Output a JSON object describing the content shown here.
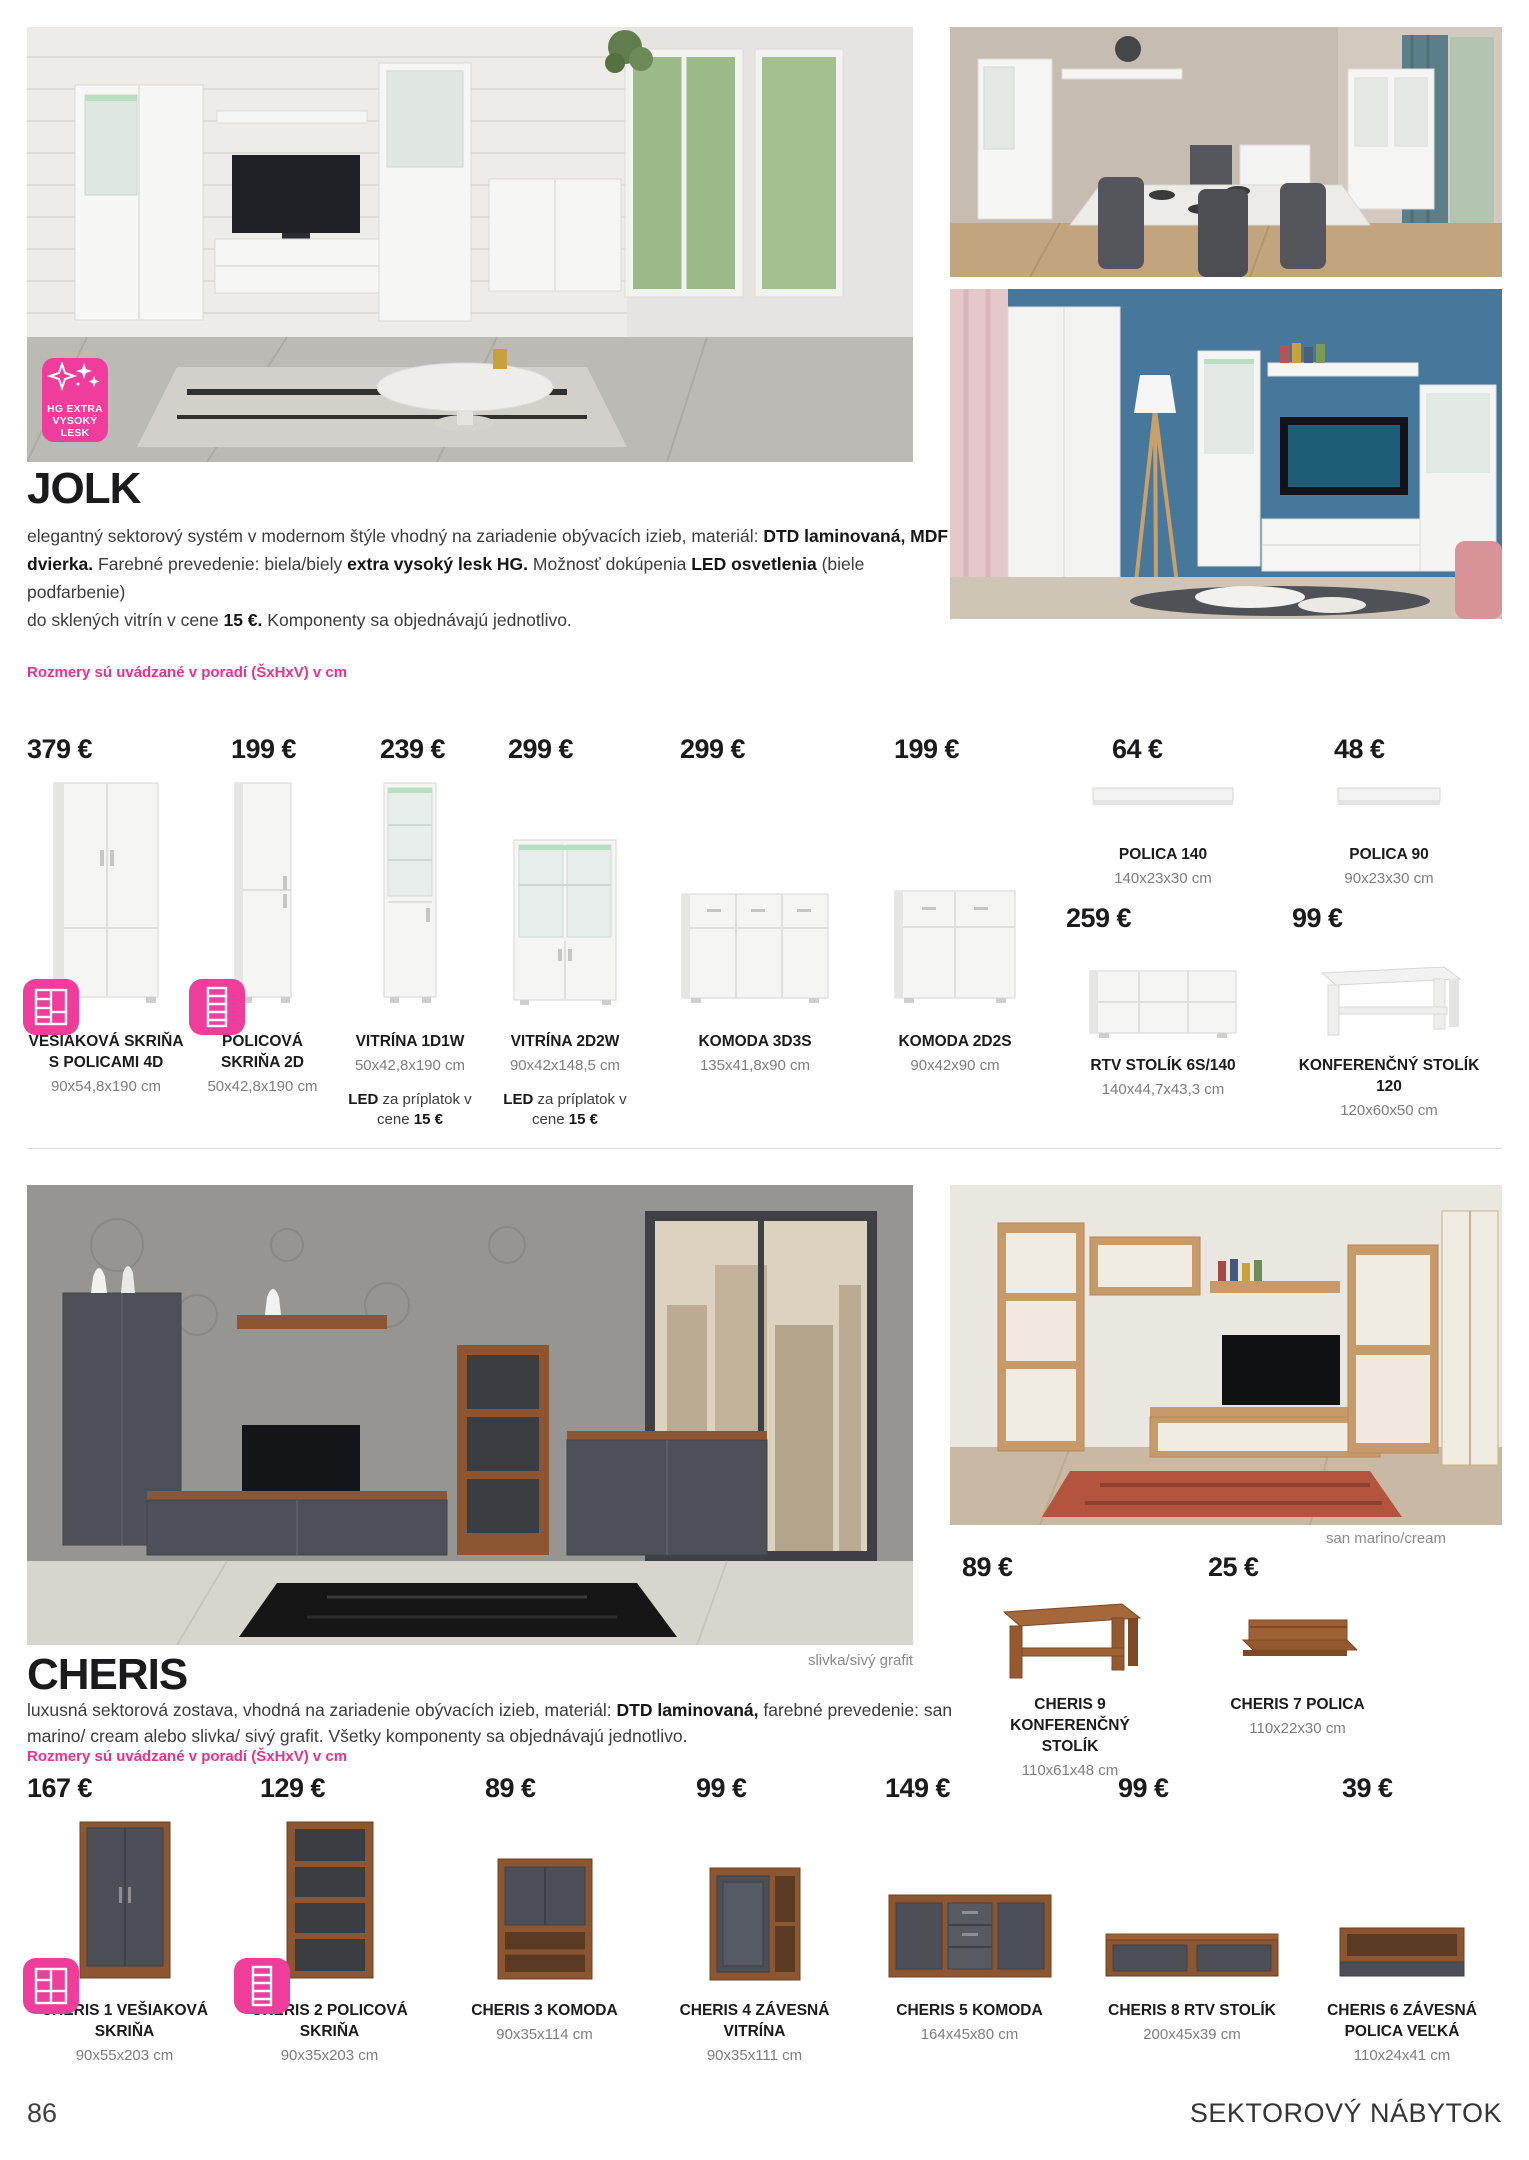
{
  "colors": {
    "accent_pink": "#e73390",
    "badge_pink": "#ee3d9b",
    "text_dark": "#1d1d1f",
    "dims_grey": "#7e7e7e"
  },
  "hg_badge": {
    "line1": "HG EXTRA",
    "line2": "VYSOKÝ",
    "line3": "LESK"
  },
  "jolk": {
    "title": "JOLK",
    "description_segments": [
      {
        "t": "elegantný sektorový systém v modernom štýle vhodný na zariadenie obývacích izieb, materiál: "
      },
      {
        "t": "DTD laminovaná, MDF",
        "b": true
      },
      {
        "br": true
      },
      {
        "t": "dvierka.",
        "b": true
      },
      {
        "t": " Farebné prevedenie: biela/biely "
      },
      {
        "t": "extra vysoký lesk HG.",
        "b": true
      },
      {
        "t": " Možnosť dokúpenia "
      },
      {
        "t": "LED osvetlenia",
        "b": true
      },
      {
        "t": " (biele podfarbenie)"
      },
      {
        "br": true
      },
      {
        "t": "do sklených vitrín v cene "
      },
      {
        "t": "15 €.",
        "b": true,
        "pink": true
      },
      {
        "t": " Komponenty sa objednávajú jednotlivo."
      }
    ],
    "size_note": "Rozmery sú uvádzané v poradí (ŠxHxV) v cm",
    "led_note": {
      "label": "LED",
      "text": "za príplatok v cene",
      "price": "15 €"
    },
    "products": [
      {
        "price": "379 €",
        "name": "VEŠIAKOVÁ SKRIŇA S POLICAMI 4D",
        "dims": "90x54,8x190 cm"
      },
      {
        "price": "199 €",
        "name": "POLICOVÁ SKRIŇA 2D",
        "dims": "50x42,8x190 cm"
      },
      {
        "price": "239 €",
        "name": "VITRÍNA 1D1W",
        "dims": "50x42,8x190 cm"
      },
      {
        "price": "299 €",
        "name": "VITRÍNA 2D2W",
        "dims": "90x42x148,5 cm"
      },
      {
        "price": "299 €",
        "name": "KOMODA 3D3S",
        "dims": "135x41,8x90 cm"
      },
      {
        "price": "199 €",
        "name": "KOMODA 2D2S",
        "dims": "90x42x90 cm"
      },
      {
        "price": "64 €",
        "name": "POLICA 140",
        "dims": "140x23x30 cm"
      },
      {
        "price": "48 €",
        "name": "POLICA 90",
        "dims": "90x23x30 cm"
      },
      {
        "price": "259 €",
        "name": "RTV STOLÍK 6S/140",
        "dims": "140x44,7x43,3 cm"
      },
      {
        "price": "99 €",
        "name": "KONFERENČNÝ STOLÍK 120",
        "dims": "120x60x50 cm"
      }
    ]
  },
  "cheris": {
    "title": "CHERIS",
    "description_segments": [
      {
        "t": "luxusná sektorová zostava, vhodná na zariadenie obývacích izieb, materiál: "
      },
      {
        "t": "DTD laminovaná,",
        "b": true
      },
      {
        "t": " farebné prevedenie: san"
      },
      {
        "br": true
      },
      {
        "t": "marino/ cream alebo slivka/ sivý grafit. Všetky komponenty sa objednávajú jednotlivo."
      }
    ],
    "size_note": "Rozmery sú uvádzané v poradí (ŠxHxV) v cm",
    "caption_left": "slivka/sivý grafit",
    "caption_right": "san marino/cream",
    "mid_products": [
      {
        "price": "89 €",
        "name": "CHERIS 9 KONFERENČNÝ STOLÍK",
        "dims": "110x61x48 cm"
      },
      {
        "price": "25 €",
        "name": "CHERIS 7 POLICA",
        "dims": "110x22x30 cm"
      }
    ],
    "products": [
      {
        "price": "167 €",
        "name": "CHERIS 1 VEŠIAKOVÁ SKRIŇA",
        "dims": "90x55x203 cm"
      },
      {
        "price": "129 €",
        "name": "CHERIS 2 POLICOVÁ SKRIŇA",
        "dims": "90x35x203 cm"
      },
      {
        "price": "89 €",
        "name": "CHERIS 3 KOMODA",
        "dims": "90x35x114 cm"
      },
      {
        "price": "99 €",
        "name": "CHERIS 4 ZÁVESNÁ VITRÍNA",
        "dims": "90x35x111 cm"
      },
      {
        "price": "149 €",
        "name": "CHERIS 5 KOMODA",
        "dims": "164x45x80 cm"
      },
      {
        "price": "99 €",
        "name": "CHERIS 8 RTV STOLÍK",
        "dims": "200x45x39 cm"
      },
      {
        "price": "39 €",
        "name": "CHERIS 6 ZÁVESNÁ POLICA VEĽKÁ",
        "dims": "110x24x41 cm"
      }
    ]
  },
  "footer": {
    "page": "86",
    "section": "SEKTOROVÝ NÁBYTOK"
  }
}
